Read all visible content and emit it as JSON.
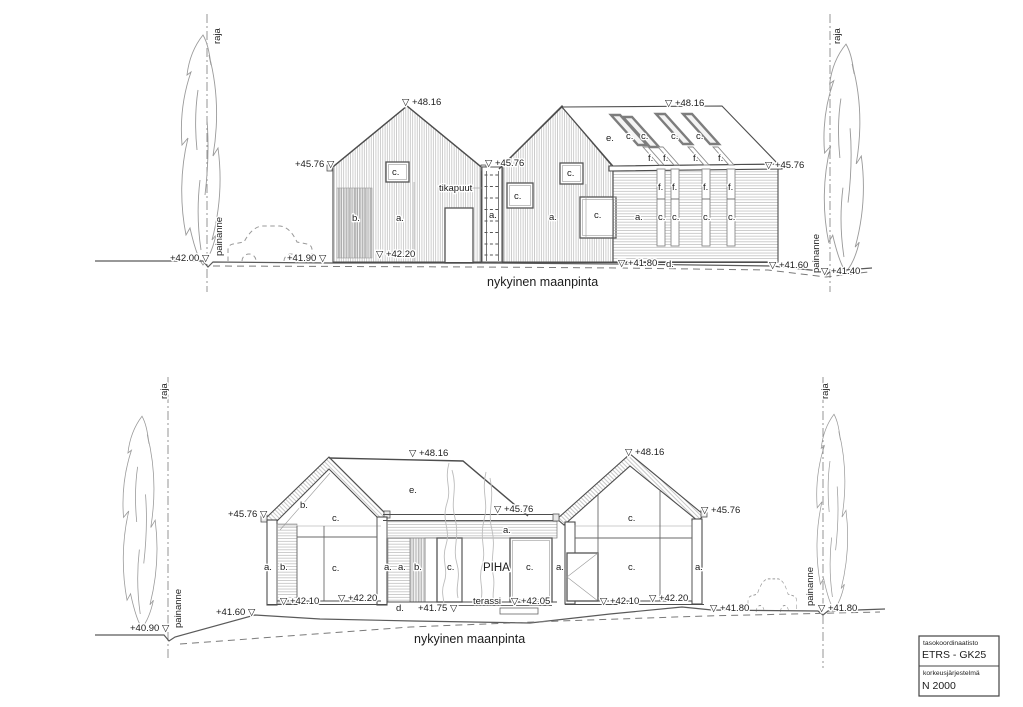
{
  "title_block": {
    "coordinate_system_label": "tasokoordinaatisto",
    "coordinate_system_value": "ETRS - GK25",
    "height_system_label": "korkeusjärjestelmä",
    "height_system_value": "N 2000"
  },
  "colors": {
    "line": "#4d4d4d",
    "hatch": "#b3b3b3",
    "text": "#1c1c1c",
    "background": "#ffffff"
  },
  "top_elevation": {
    "labels": [
      {
        "n": "level-ridge-left-house",
        "t": "▽ +48.16",
        "x": 402,
        "y": 105
      },
      {
        "n": "level-eave-left-house",
        "t": "+45.76 ▽",
        "x": 295,
        "y": 167
      },
      {
        "n": "level-valley",
        "t": "▽ +45.76",
        "x": 485,
        "y": 166
      },
      {
        "n": "level-ridge-right-house",
        "t": "▽ +48.16",
        "x": 665,
        "y": 106
      },
      {
        "n": "level-eave-right-house",
        "t": "▽ +45.76",
        "x": 765,
        "y": 168
      },
      {
        "n": "level-ground-42-00",
        "t": "+42.00 ▽",
        "x": 170,
        "y": 261
      },
      {
        "n": "level-ground-41-90",
        "t": "+41.90 ▽",
        "x": 287,
        "y": 261
      },
      {
        "n": "level-floor-42-20",
        "t": "▽ +42.20",
        "x": 376,
        "y": 257
      },
      {
        "n": "level-ground-41-80",
        "t": "▽ +41.80",
        "x": 618,
        "y": 266
      },
      {
        "n": "level-ground-41-60",
        "t": "▽ +41.60",
        "x": 769,
        "y": 268
      },
      {
        "n": "level-ground-41-40",
        "t": "▽ +41.40",
        "x": 821,
        "y": 274
      },
      {
        "n": "ladder-label",
        "t": "tikapuut",
        "x": 439,
        "y": 191
      },
      {
        "n": "part-b-screen",
        "t": "b.",
        "x": 352,
        "y": 221
      },
      {
        "n": "part-a-wall-1",
        "t": "a.",
        "x": 396,
        "y": 221
      },
      {
        "n": "part-c-window-1",
        "t": "c.",
        "x": 392,
        "y": 175
      },
      {
        "n": "part-a-ladder-bay",
        "t": "a.",
        "x": 489,
        "y": 218
      },
      {
        "n": "part-c-window-2",
        "t": "c.",
        "x": 514,
        "y": 199
      },
      {
        "n": "part-c-window-3",
        "t": "c.",
        "x": 567,
        "y": 176
      },
      {
        "n": "part-a-wall-2",
        "t": "a.",
        "x": 549,
        "y": 220
      },
      {
        "n": "part-c-window-4",
        "t": "c.",
        "x": 594,
        "y": 218
      },
      {
        "n": "part-e-roof",
        "t": "e.",
        "x": 606,
        "y": 141
      },
      {
        "n": "part-c-skylight-1",
        "t": "c.",
        "x": 626,
        "y": 139
      },
      {
        "n": "part-c-skylight-2",
        "t": "c.",
        "x": 641,
        "y": 139
      },
      {
        "n": "part-c-skylight-3",
        "t": "c.",
        "x": 671,
        "y": 139
      },
      {
        "n": "part-c-skylight-4",
        "t": "c.",
        "x": 696,
        "y": 139
      },
      {
        "n": "part-f-roof-1",
        "t": "f.",
        "x": 648,
        "y": 161
      },
      {
        "n": "part-f-roof-2",
        "t": "f.",
        "x": 663,
        "y": 161
      },
      {
        "n": "part-f-roof-3",
        "t": "f.",
        "x": 693,
        "y": 161
      },
      {
        "n": "part-f-roof-4",
        "t": "f.",
        "x": 718,
        "y": 161
      },
      {
        "n": "part-f-strip-1",
        "t": "f.",
        "x": 658,
        "y": 190
      },
      {
        "n": "part-f-strip-2",
        "t": "f.",
        "x": 672,
        "y": 190
      },
      {
        "n": "part-f-strip-3",
        "t": "f.",
        "x": 703,
        "y": 190
      },
      {
        "n": "part-f-strip-4",
        "t": "f.",
        "x": 728,
        "y": 190
      },
      {
        "n": "part-a-wall-3",
        "t": "a.",
        "x": 635,
        "y": 220
      },
      {
        "n": "part-c-strip-1",
        "t": "c.",
        "x": 658,
        "y": 220
      },
      {
        "n": "part-c-strip-2",
        "t": "c.",
        "x": 672,
        "y": 220
      },
      {
        "n": "part-c-strip-3",
        "t": "c.",
        "x": 703,
        "y": 220
      },
      {
        "n": "part-c-strip-4",
        "t": "c.",
        "x": 728,
        "y": 220
      },
      {
        "n": "part-d-ground",
        "t": "d.",
        "x": 666,
        "y": 267
      },
      {
        "n": "ground-surface-label",
        "t": "nykyinen maanpinta",
        "x": 487,
        "y": 286,
        "s": 12.5
      },
      {
        "n": "boundary-left-label",
        "t": "raja",
        "x": 220,
        "y": 44,
        "r": -90
      },
      {
        "n": "depression-left-label",
        "t": "painanne",
        "x": 222,
        "y": 256,
        "r": -90
      },
      {
        "n": "boundary-right-label",
        "t": "raja",
        "x": 840,
        "y": 44,
        "r": -90
      },
      {
        "n": "depression-right-label",
        "t": "painanne",
        "x": 819,
        "y": 273,
        "r": -90
      }
    ]
  },
  "bottom_elevation": {
    "labels": [
      {
        "n": "level-ridge-line",
        "t": "▽ +48.16",
        "x": 409,
        "y": 456
      },
      {
        "n": "level-ridge-right-house",
        "t": "▽ +48.16",
        "x": 625,
        "y": 455
      },
      {
        "n": "level-eave-left-house",
        "t": "+45.76 ▽",
        "x": 228,
        "y": 517
      },
      {
        "n": "level-eave-middle",
        "t": "▽ +45.76",
        "x": 494,
        "y": 512
      },
      {
        "n": "level-eave-right-house",
        "t": "▽ +45.76",
        "x": 701,
        "y": 513
      },
      {
        "n": "level-ground-41-60",
        "t": "+41.60 ▽",
        "x": 216,
        "y": 615
      },
      {
        "n": "level-ground-40-90",
        "t": "+40.90 ▽",
        "x": 130,
        "y": 631
      },
      {
        "n": "level-floor-42-10-left",
        "t": "▽ +42.10",
        "x": 280,
        "y": 604
      },
      {
        "n": "level-floor-42-20-left",
        "t": "▽ +42.20",
        "x": 338,
        "y": 601
      },
      {
        "n": "part-d-ground",
        "t": "d.",
        "x": 396,
        "y": 611
      },
      {
        "n": "level-ground-41-75",
        "t": "+41.75 ▽",
        "x": 418,
        "y": 611
      },
      {
        "n": "terrace-label",
        "t": "terassi",
        "x": 473,
        "y": 604
      },
      {
        "n": "level-terrace-42-05",
        "t": "▽ +42.05",
        "x": 511,
        "y": 604
      },
      {
        "n": "level-floor-42-10-right",
        "t": "▽ +42.10",
        "x": 600,
        "y": 604
      },
      {
        "n": "level-floor-42-20-right",
        "t": "▽ +42.20",
        "x": 649,
        "y": 601
      },
      {
        "n": "level-ground-41-80-1",
        "t": "▽ +41.80",
        "x": 710,
        "y": 611
      },
      {
        "n": "level-ground-41-80-2",
        "t": "▽ +41.80",
        "x": 818,
        "y": 611
      },
      {
        "n": "part-b-roof-inner",
        "t": "b.",
        "x": 300,
        "y": 508
      },
      {
        "n": "part-c-gable-window",
        "t": "c.",
        "x": 332,
        "y": 521
      },
      {
        "n": "part-a-left-wall",
        "t": "a.",
        "x": 264,
        "y": 570
      },
      {
        "n": "part-b-left-band",
        "t": "b.",
        "x": 280,
        "y": 570
      },
      {
        "n": "part-c-main-window-left",
        "t": "c.",
        "x": 332,
        "y": 571
      },
      {
        "n": "part-e-roof",
        "t": "e.",
        "x": 409,
        "y": 493
      },
      {
        "n": "part-a-fascia",
        "t": "a.",
        "x": 503,
        "y": 533
      },
      {
        "n": "part-a-mid-1",
        "t": "a.",
        "x": 384,
        "y": 570
      },
      {
        "n": "part-a-mid-2",
        "t": "a.",
        "x": 398,
        "y": 570
      },
      {
        "n": "part-b-mid",
        "t": "b.",
        "x": 414,
        "y": 570
      },
      {
        "n": "part-c-mid-1",
        "t": "c.",
        "x": 447,
        "y": 570
      },
      {
        "n": "courtyard-label",
        "t": "PIHA",
        "x": 483,
        "y": 571,
        "s": 11.5
      },
      {
        "n": "part-c-mid-2",
        "t": "c.",
        "x": 526,
        "y": 570
      },
      {
        "n": "part-a-mid-3",
        "t": "a.",
        "x": 556,
        "y": 570
      },
      {
        "n": "part-c-gable-right",
        "t": "c.",
        "x": 628,
        "y": 521
      },
      {
        "n": "part-c-main-window-right",
        "t": "c.",
        "x": 628,
        "y": 570
      },
      {
        "n": "part-a-right-wall",
        "t": "a.",
        "x": 695,
        "y": 570
      },
      {
        "n": "ground-surface-label",
        "t": "nykyinen maanpinta",
        "x": 414,
        "y": 643,
        "s": 12.5
      },
      {
        "n": "boundary-left-label",
        "t": "raja",
        "x": 167,
        "y": 399,
        "r": -90
      },
      {
        "n": "depression-left-label",
        "t": "painanne",
        "x": 181,
        "y": 628,
        "r": -90
      },
      {
        "n": "boundary-right-label",
        "t": "raja",
        "x": 828,
        "y": 399,
        "r": -90
      },
      {
        "n": "depression-right-label",
        "t": "painanne",
        "x": 813,
        "y": 606,
        "r": -90
      }
    ]
  }
}
